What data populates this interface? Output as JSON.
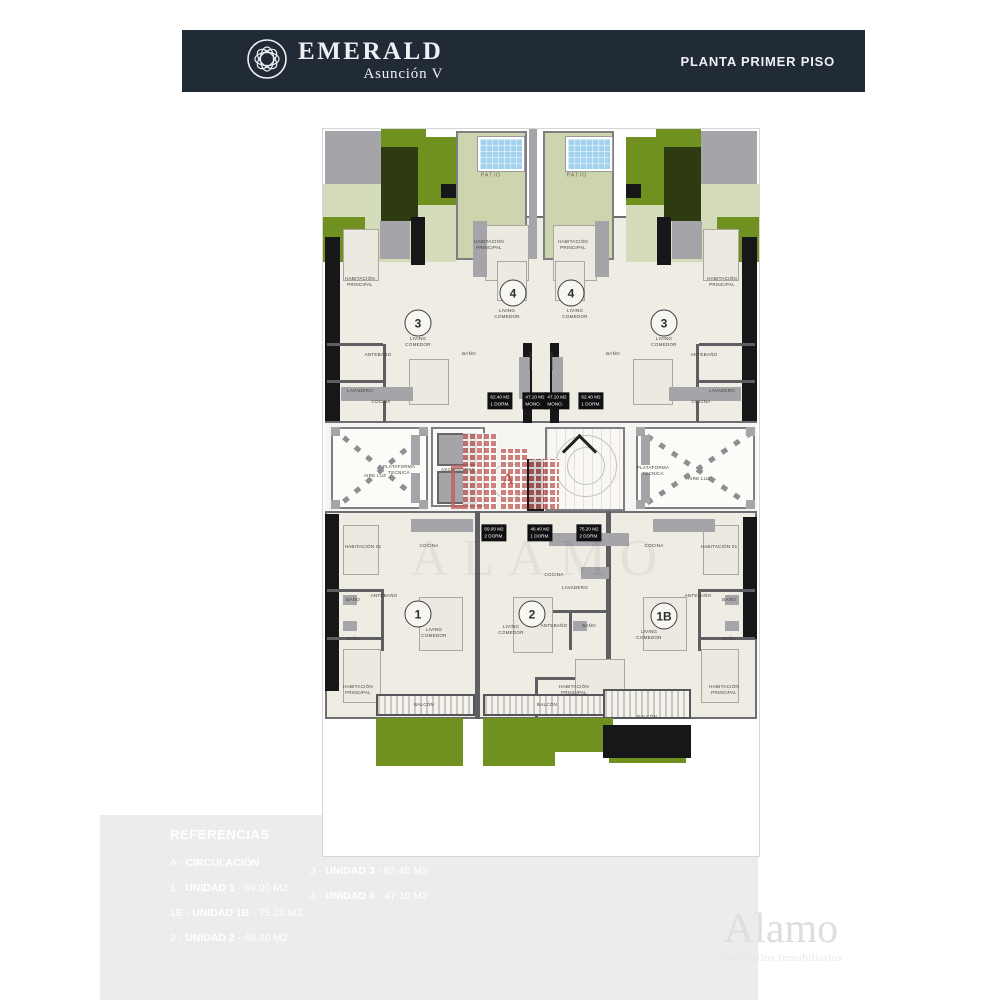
{
  "header": {
    "brand": "EMERALD",
    "brand_sub": "Asunción V",
    "page_title": "PLANTA PRIMER PISO",
    "logo_icon": "emerald-emblem"
  },
  "plan": {
    "watermark": "ALAMO",
    "circulation_letter": "A",
    "room_labels": [
      {
        "t": "PATIO",
        "x": 168,
        "y": 47,
        "cls": "pt"
      },
      {
        "t": "PATIO",
        "x": 254,
        "y": 47,
        "cls": "pt"
      },
      {
        "t": "HABITACIÓN\nPRINCIPAL",
        "x": 37,
        "y": 153
      },
      {
        "t": "HABITACIÓN\nPRINCIPAL",
        "x": 166,
        "y": 116
      },
      {
        "t": "HABITACIÓN\nPRINCIPAL",
        "x": 250,
        "y": 116
      },
      {
        "t": "HABITACIÓN\nPRINCIPAL",
        "x": 399,
        "y": 153
      },
      {
        "t": "LIVING\nCOMEDOR",
        "x": 95,
        "y": 213
      },
      {
        "t": "LIVING\nCOMEDOR",
        "x": 184,
        "y": 185
      },
      {
        "t": "LIVING\nCOMEDOR",
        "x": 252,
        "y": 185
      },
      {
        "t": "LIVING\nCOMEDOR",
        "x": 341,
        "y": 213
      },
      {
        "t": "ANTEBAÑO",
        "x": 55,
        "y": 226
      },
      {
        "t": "ANTEBAÑO",
        "x": 381,
        "y": 226
      },
      {
        "t": "BAÑO",
        "x": 146,
        "y": 225
      },
      {
        "t": "BAÑO",
        "x": 290,
        "y": 225
      },
      {
        "t": "LAVADERO",
        "x": 37,
        "y": 262
      },
      {
        "t": "LAVADERO",
        "x": 399,
        "y": 262
      },
      {
        "t": "COCINA",
        "x": 58,
        "y": 273
      },
      {
        "t": "COCINA",
        "x": 378,
        "y": 273
      },
      {
        "t": "COCINA",
        "x": 208,
        "y": 232,
        "cls": "v"
      },
      {
        "t": "COCINA",
        "x": 229,
        "y": 232,
        "cls": "v"
      },
      {
        "t": "PLATAFORMA\nTECNICA",
        "x": 76,
        "y": 341
      },
      {
        "t": "ASCENSORES",
        "x": 135,
        "y": 341
      },
      {
        "t": "AIRE LUZ",
        "x": 52,
        "y": 347
      },
      {
        "t": "PLATAFORMA\nTECNICA",
        "x": 330,
        "y": 342
      },
      {
        "t": "AIRE LUZ",
        "x": 376,
        "y": 350
      },
      {
        "t": "HABITACIÓN 01",
        "x": 40,
        "y": 418
      },
      {
        "t": "HABITACIÓN 01",
        "x": 396,
        "y": 418
      },
      {
        "t": "COCINA",
        "x": 106,
        "y": 417
      },
      {
        "t": "COCINA",
        "x": 331,
        "y": 417
      },
      {
        "t": "COCINA",
        "x": 231,
        "y": 446
      },
      {
        "t": "LAVADERO",
        "x": 252,
        "y": 459
      },
      {
        "t": "ANTEBAÑO",
        "x": 61,
        "y": 467
      },
      {
        "t": "ANTEBAÑO",
        "x": 231,
        "y": 497
      },
      {
        "t": "ANTEBAÑO",
        "x": 375,
        "y": 467
      },
      {
        "t": "BAÑO",
        "x": 30,
        "y": 471
      },
      {
        "t": "BAÑO",
        "x": 30,
        "y": 510
      },
      {
        "t": "BAÑO",
        "x": 266,
        "y": 497
      },
      {
        "t": "BAÑO",
        "x": 406,
        "y": 471
      },
      {
        "t": "BAÑO",
        "x": 406,
        "y": 510
      },
      {
        "t": "LIVING\nCOMEDOR",
        "x": 111,
        "y": 504
      },
      {
        "t": "LIVING\nCOMEDOR",
        "x": 188,
        "y": 501
      },
      {
        "t": "LIVING\nCOMEDOR",
        "x": 326,
        "y": 506
      },
      {
        "t": "HABITACIÓN\nPRINCIPAL",
        "x": 35,
        "y": 561
      },
      {
        "t": "HABITACIÓN\nPRINCIPAL",
        "x": 251,
        "y": 561
      },
      {
        "t": "HABITACIÓN\nPRINCIPAL",
        "x": 401,
        "y": 561
      },
      {
        "t": "BALCÓN",
        "x": 101,
        "y": 576
      },
      {
        "t": "BALCÓN",
        "x": 224,
        "y": 576
      },
      {
        "t": "BALCÓN",
        "x": 324,
        "y": 588
      }
    ],
    "unit_badges": [
      {
        "t": "3",
        "x": 95,
        "y": 194
      },
      {
        "t": "4",
        "x": 190,
        "y": 164
      },
      {
        "t": "4",
        "x": 248,
        "y": 164
      },
      {
        "t": "3",
        "x": 341,
        "y": 194
      },
      {
        "t": "1",
        "x": 95,
        "y": 485
      },
      {
        "t": "2",
        "x": 209,
        "y": 485
      },
      {
        "t": "1B",
        "x": 341,
        "y": 487
      }
    ],
    "area_chips": [
      {
        "t": "62.40 M2\n1 DORM.",
        "x": 177,
        "y": 272
      },
      {
        "t": "47.10 M2\nMONO.",
        "x": 212,
        "y": 272
      },
      {
        "t": "47.10 M2\nMONO.",
        "x": 234,
        "y": 272
      },
      {
        "t": "62.40 M2\n1 DORM.",
        "x": 268,
        "y": 272
      },
      {
        "t": "69.00 M2\n2 DORM.",
        "x": 171,
        "y": 404
      },
      {
        "t": "46.40 M2\n1 DORM.",
        "x": 217,
        "y": 404
      },
      {
        "t": "75.20 M2\n2 DORM.",
        "x": 266,
        "y": 404
      }
    ]
  },
  "references": {
    "title": "REFERENCIAS",
    "columns": [
      [
        {
          "key": "A",
          "name": "CIRCULACIÓN",
          "area": ""
        },
        {
          "key": "1",
          "name": "UNIDAD 1",
          "area": "69.00 M2"
        },
        {
          "key": "1B",
          "name": "UNIDAD 1B",
          "area": "75.20 M2"
        },
        {
          "key": "2",
          "name": "UNIDAD 2",
          "area": "46.40 M2"
        }
      ],
      [
        {
          "key": "3",
          "name": "UNIDAD 3",
          "area": "62.40 M2"
        },
        {
          "key": "4",
          "name": "UNIDAD 4",
          "area": "47.10 M2"
        }
      ]
    ]
  },
  "developer": {
    "name": "Alamo",
    "tagline": "Desarrollos Inmobiliarios"
  }
}
